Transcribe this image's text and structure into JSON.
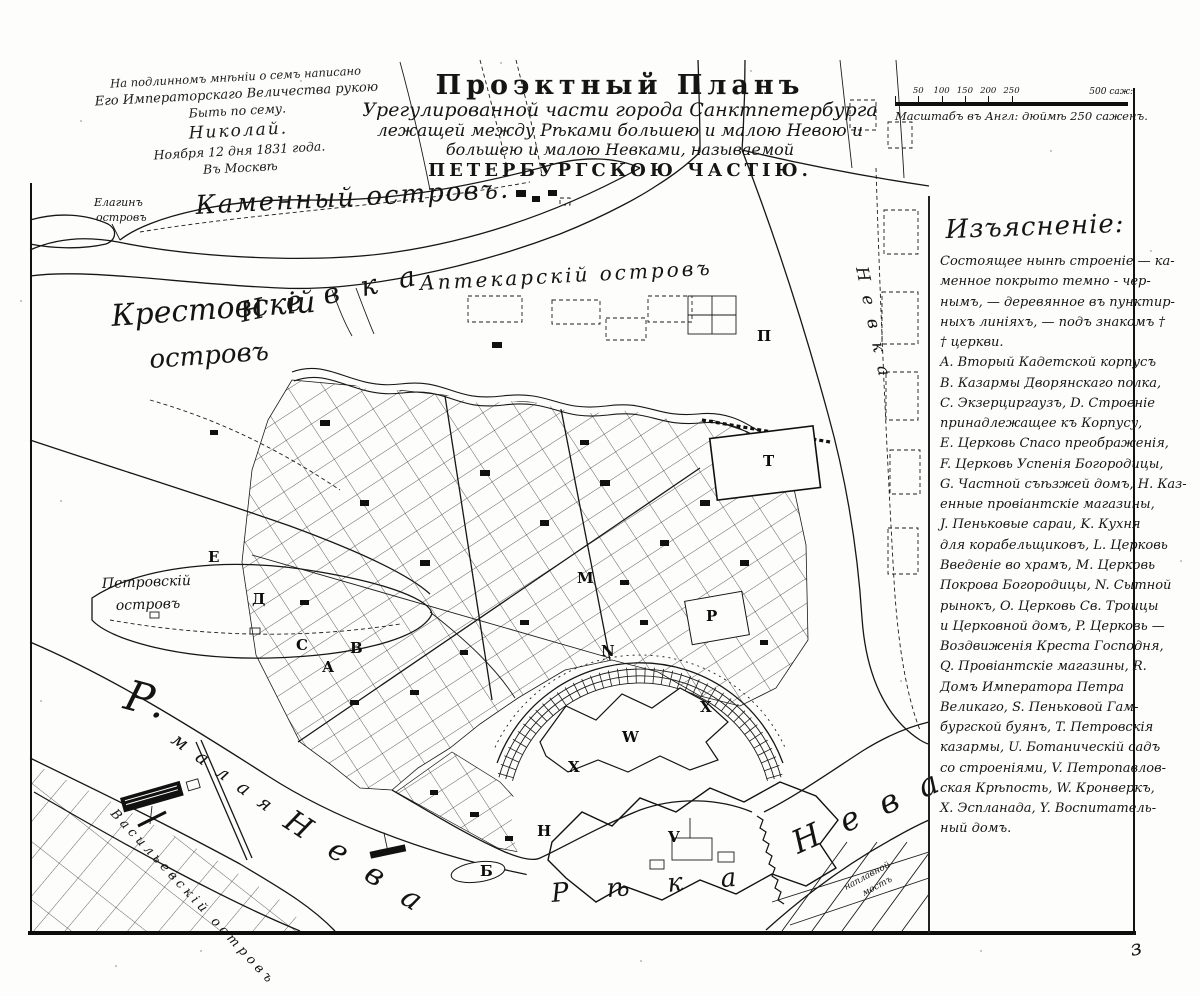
{
  "sheet": {
    "corner_mark": "з"
  },
  "note": {
    "lines": [
      "На подлинномъ мнѣніи о семъ написано",
      "Его Императорскаго Величества рукою",
      "Быть по сему.",
      "Николай.",
      "Ноября 12 дня 1831 года.",
      "Въ Москвѣ"
    ]
  },
  "title": {
    "lines": [
      "Проэктный Планъ",
      "Урегулированной части города Санктпетербурга",
      "лежащей между Рѣками большею и малою Невою и",
      "большею и малою Невками, называемой",
      "ПЕТЕРБУРГСКОЮ ЧАСТІЮ."
    ]
  },
  "scale": {
    "tick_labels": [
      "50",
      "100",
      "150",
      "200",
      "250"
    ],
    "end_label": "500 саж:",
    "caption": "Масштабъ въ Англ: дюймѣ 250 саженъ."
  },
  "legend": {
    "header": "Изъясненіе:",
    "lines": [
      "Состоящее нынѣ строеніе — ка-",
      "менное покрыто темно - чер-",
      "нымъ, — деревянное въ пунктир-",
      "ныхъ линіяхъ, — подъ знакомъ †",
      "† церкви.",
      "A. Вторый Кадетской корпусъ",
      "B. Казармы Дворянскаго полка,",
      "C. Экзерциргаузъ, D. Строеніе",
      "принадлежащее къ Корпусу,",
      "E. Церковь Спасо преображенія,",
      "F. Церковь Успенія Богородицы,",
      "G. Частной съѣзжей домъ, H. Каз-",
      "енные провіантскіе магазины,",
      "J. Пеньковые сараи, K. Кухня",
      "для корабельщиковъ, L. Церковь",
      "Введеніе во храмъ, M. Церковь",
      "Покрова Богородицы, N. Сытной",
      "рынокъ, O. Церковь Св. Троицы",
      "и Церковной домъ, P. Церковь —",
      "Воздвиженія Креста Господня,",
      "Q. Провіантскіе магазины, R.",
      "Домъ Императора Петра",
      "Великаго, S. Пеньковой Гам-",
      "бургской буянъ, T. Петровскія",
      "казармы, U. Ботаническій садъ",
      "со строеніями, V. Петропавлов-",
      "ская Крѣпость, W. Кронверкъ,",
      "X. Эспланада, Y. Воспитатель-",
      "ный домъ."
    ]
  },
  "map": {
    "labels": {
      "elagin_1": "Елагинъ",
      "elagin_2": "островъ",
      "kamenny": "Каменный островъ.",
      "krestovsky_1": "Крестовскій",
      "krestovsky_2": "островъ",
      "aptekarsky": "Аптекарскій островъ",
      "petrovsky_1": "Петровскій",
      "petrovsky_2": "островъ",
      "vasilievsky": "Васильевскій островъ",
      "nevka_upper": "Невка",
      "nevka_right": "Невка",
      "reka": "Рѣка",
      "neva": "Нева",
      "malaya_r": "Р.",
      "malaya": "малая",
      "malaya_neva": "Нева",
      "bridge_1": "наплавной",
      "bridge_2": "мостъ"
    },
    "markers": [
      {
        "letter": "Е",
        "x": 208,
        "y": 562
      },
      {
        "letter": "Д",
        "x": 252,
        "y": 604
      },
      {
        "letter": "С",
        "x": 296,
        "y": 650
      },
      {
        "letter": "А",
        "x": 322,
        "y": 672
      },
      {
        "letter": "В",
        "x": 350,
        "y": 653
      },
      {
        "letter": "М",
        "x": 577,
        "y": 583
      },
      {
        "letter": "N",
        "x": 601,
        "y": 656
      },
      {
        "letter": "Р",
        "x": 706,
        "y": 621
      },
      {
        "letter": "Т",
        "x": 763,
        "y": 466
      },
      {
        "letter": "П",
        "x": 757,
        "y": 341
      },
      {
        "letter": "W",
        "x": 622,
        "y": 742
      },
      {
        "letter": "X",
        "x": 700,
        "y": 712
      },
      {
        "letter": "X",
        "x": 568,
        "y": 772
      },
      {
        "letter": "V",
        "x": 668,
        "y": 842
      },
      {
        "letter": "Н",
        "x": 537,
        "y": 836
      },
      {
        "letter": "Б",
        "x": 480,
        "y": 876
      }
    ]
  }
}
